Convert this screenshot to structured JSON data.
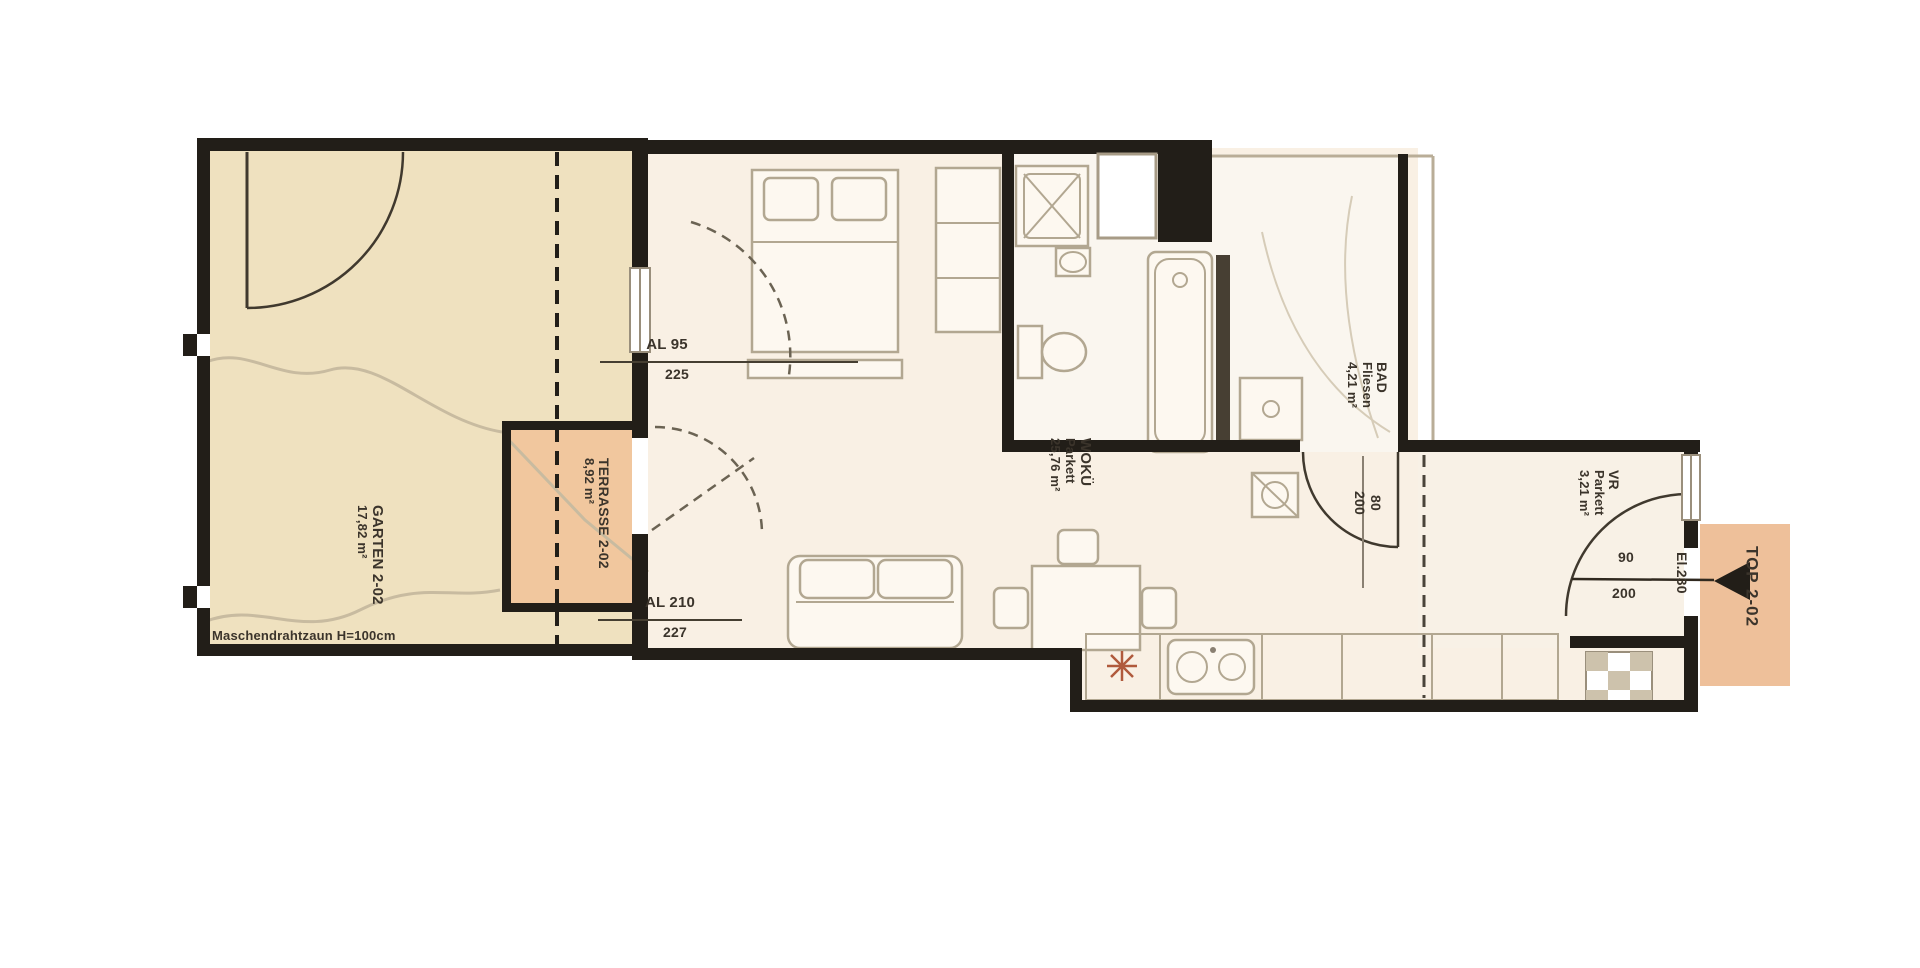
{
  "rooms": {
    "garten": {
      "name": "GARTEN 2-02",
      "area": "17,82 m²"
    },
    "terrasse": {
      "name": "TERRASSE 2-02",
      "area": "8,92 m²"
    },
    "bad": {
      "name": "BAD",
      "floor": "Fliesen",
      "area": "4,21 m²"
    },
    "wokue": {
      "name": "WOKÜ",
      "floor": "Parkett",
      "area": "25,76 m²"
    },
    "vr": {
      "name": "VR",
      "floor": "Parkett",
      "area": "3,21 m²"
    }
  },
  "dimensions": {
    "window_garden": {
      "top": "AL 95",
      "bottom": "225"
    },
    "door_terrace": {
      "top": "AL 210",
      "bottom": "227"
    },
    "door_bad": {
      "top": "80",
      "bottom": "200"
    },
    "door_entry": {
      "top": "90",
      "bottom": "200"
    }
  },
  "annotations": {
    "fence": "Maschendrahtzaun H=100cm",
    "entry_height": "El.230",
    "unit": "TOP 2-02"
  },
  "colors": {
    "paper": "#ffffff",
    "garden": "#efe1bf",
    "terrace": "#f1c79e",
    "apartment": "#f9f0e4",
    "bathroom": "#faf6ef",
    "vr": "#f8f1e6",
    "top-marker": "#eec09a",
    "wall": "#221e18",
    "furniture": "#b2a791",
    "text": "#3b342b"
  }
}
